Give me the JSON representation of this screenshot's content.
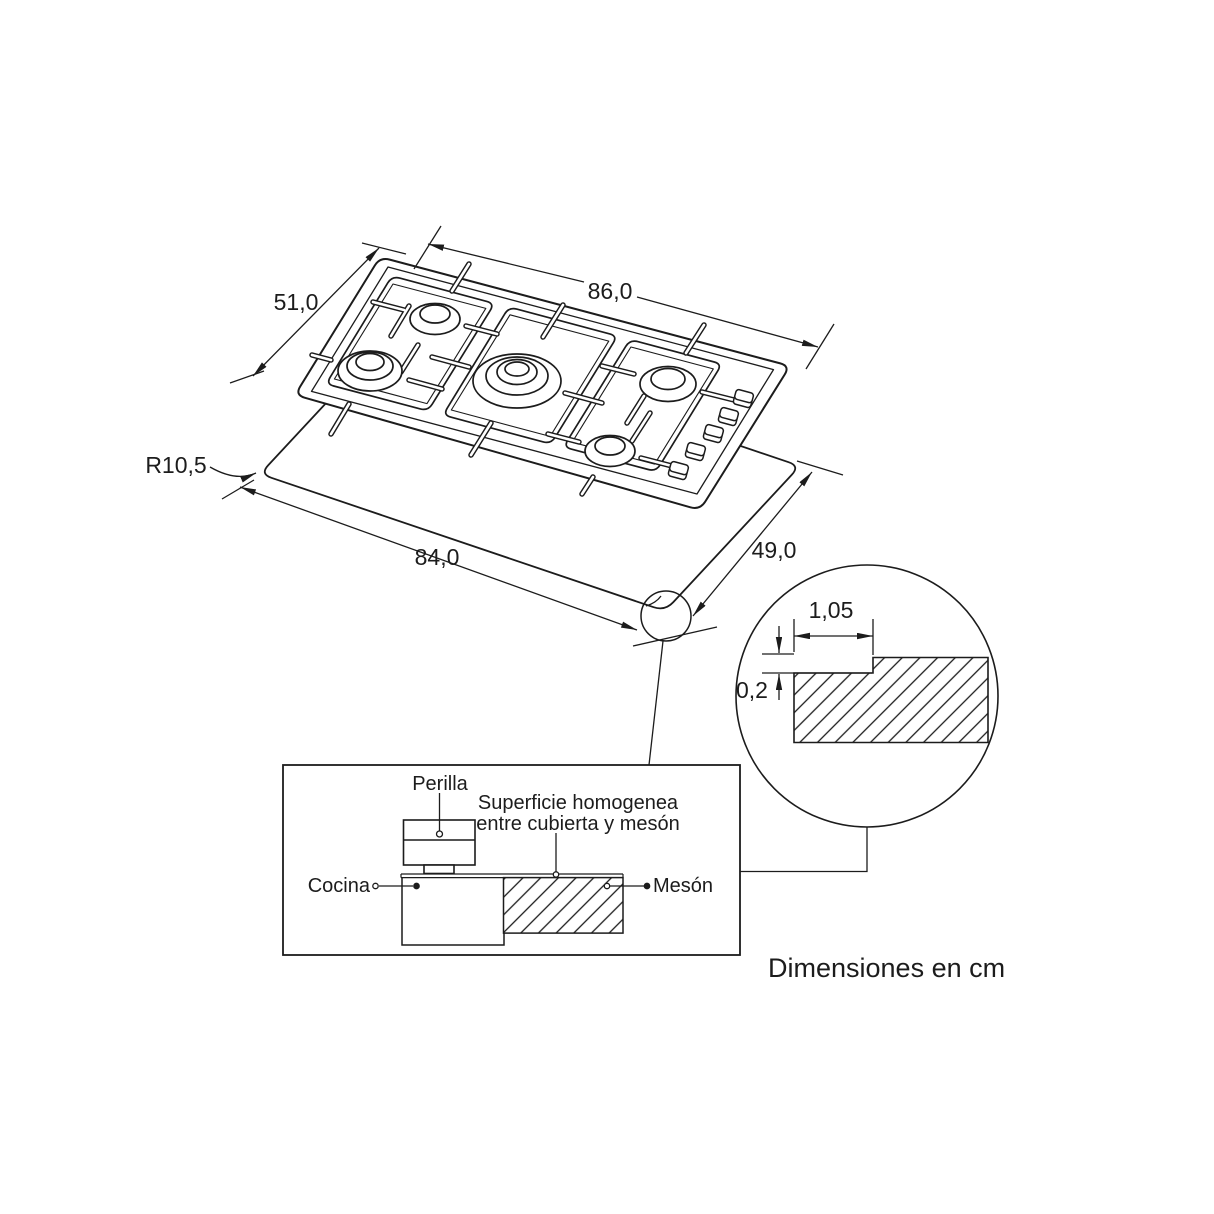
{
  "note": "Dimensiones en cm",
  "cooktop": {
    "width_cm": "86,0",
    "depth_cm": "51,0",
    "burner_count": 5,
    "knob_count": 5
  },
  "cutout": {
    "width_cm": "84,0",
    "depth_cm": "49,0",
    "corner_radius": "R10,5"
  },
  "edge_detail": {
    "overlap_cm": "1,05",
    "lip_height_cm": "0,2"
  },
  "installation_view": {
    "knob_label": "Perilla",
    "surface_label_line1": "Superficie homogenea",
    "surface_label_line2": "entre cubierta y mesón",
    "stove_label": "Cocina",
    "countertop_label": "Mesón"
  },
  "colors": {
    "line": "#1c1c1c",
    "background": "#ffffff"
  }
}
